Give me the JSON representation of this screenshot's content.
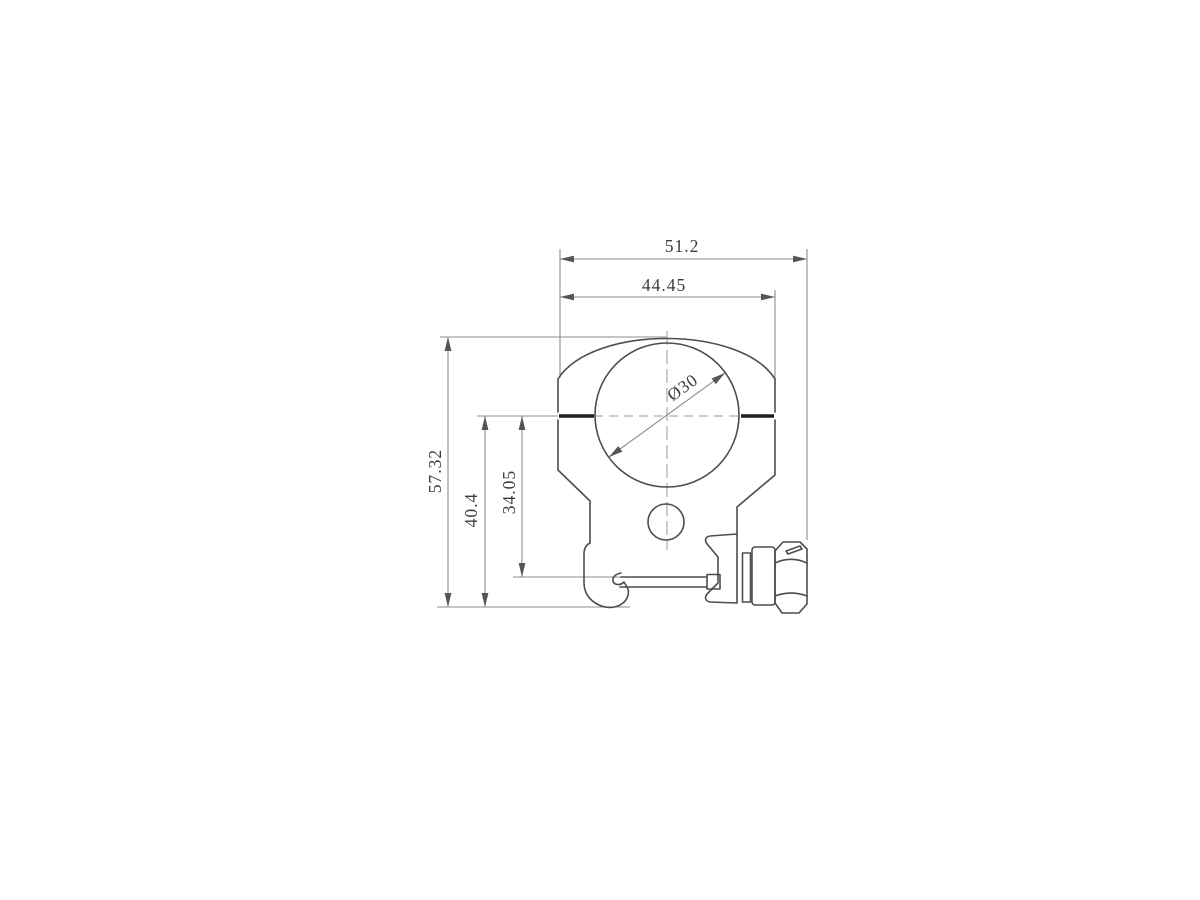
{
  "drawing": {
    "kind": "technical-dimension-drawing",
    "subject": "scope-ring-mount-front-view",
    "dimensions": {
      "overall_width": "51.2",
      "ring_outer_width": "44.45",
      "overall_height": "57.32",
      "base_to_split_height": "40.4",
      "rail_to_split_height": "34.05",
      "bore_diameter": "Ø30"
    },
    "colors": {
      "background": "#ffffff",
      "body_line": "#4d4d4d",
      "dimension_line": "#8c8c8c",
      "bold_split_line": "#1f1f1f",
      "center_line": "#9a9a9a",
      "text": "#3c3c3c",
      "arrow": "#555555"
    }
  }
}
